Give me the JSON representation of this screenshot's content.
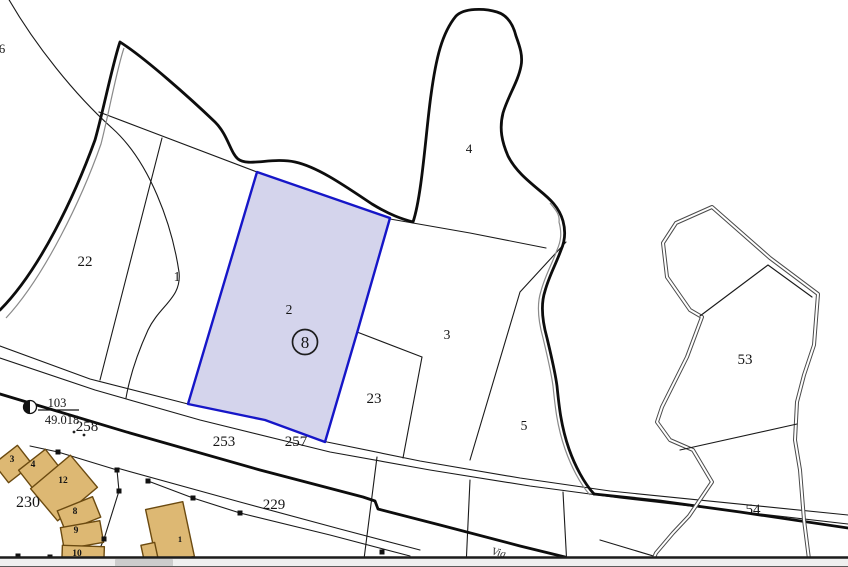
{
  "labels": {
    "p6": "6",
    "p22": "22",
    "p1": "1",
    "p2": "2",
    "p3": "3",
    "p4": "4",
    "p5": "5",
    "p23": "23",
    "p53": "53",
    "p54": "54",
    "p230": "230",
    "p253": "253",
    "p257": "257",
    "p258": "258",
    "p229": "229",
    "badge": "8",
    "survey_number": "103",
    "survey_elevation": "49.018",
    "b3": "3",
    "b4": "4",
    "b12": "12",
    "b8": "8",
    "b9": "9",
    "b10": "10",
    "b1": "1",
    "street": "Via"
  },
  "selected_parcel": {
    "number": "2",
    "badge": "8"
  },
  "colors": {
    "selection_fill": "#cdcde9",
    "selection_border": "#1616c8",
    "building_fill": "#ddb873",
    "building_stroke": "#6b4a10",
    "line": "#1a1a1a"
  }
}
